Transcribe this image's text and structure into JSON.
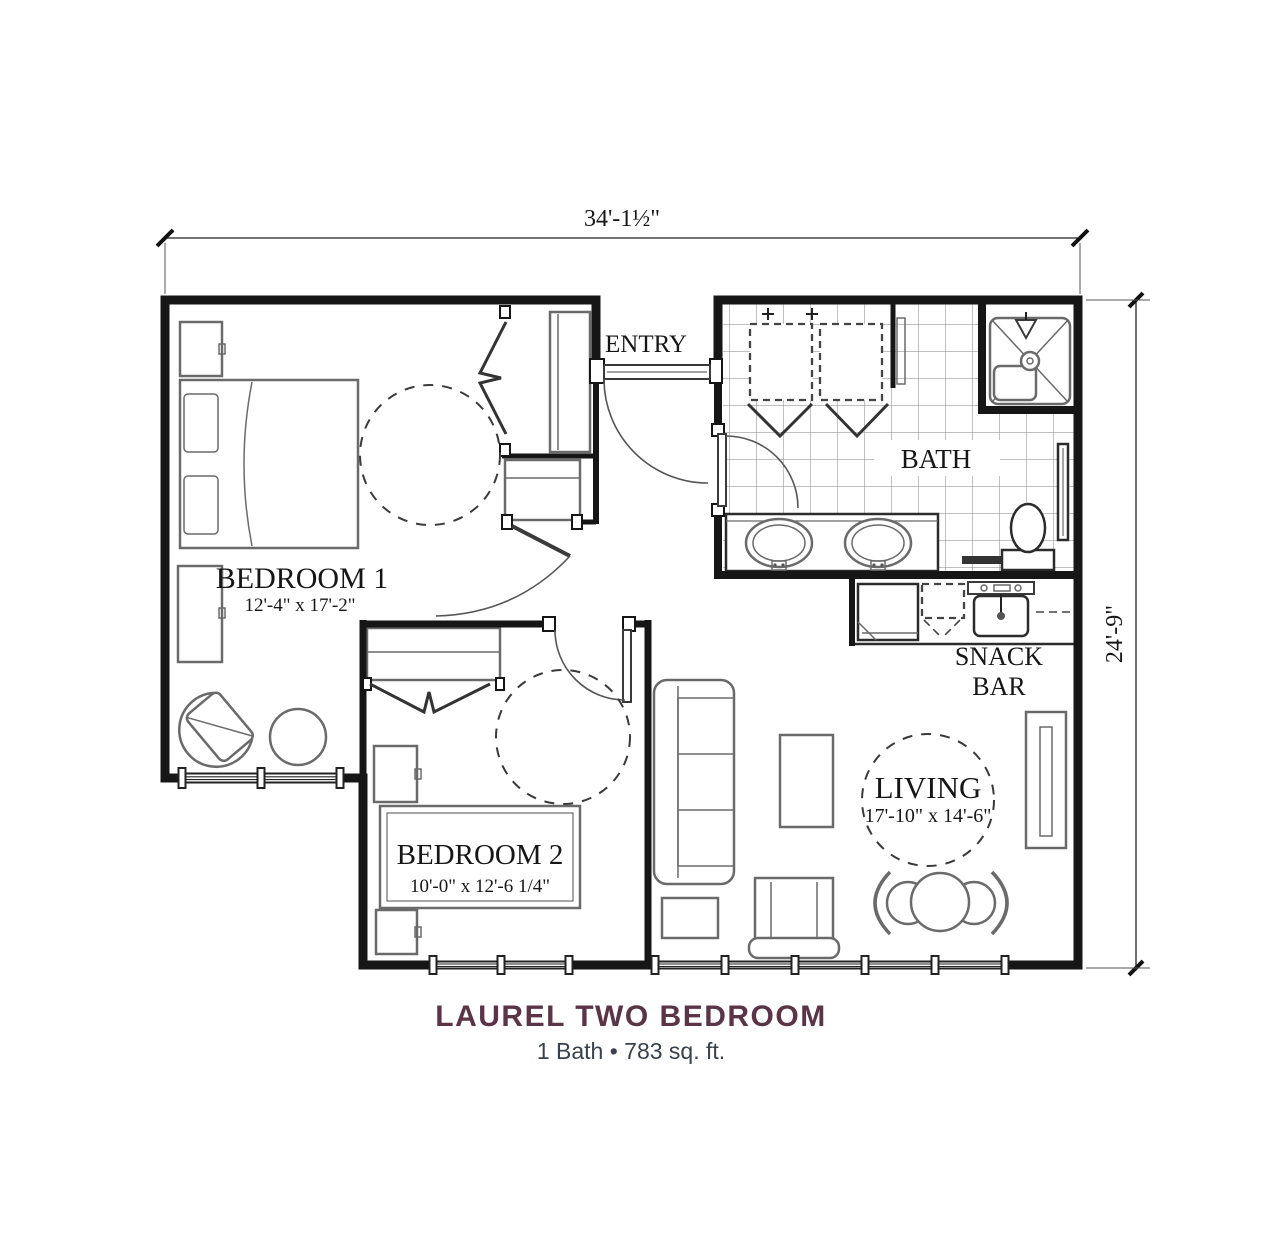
{
  "dimensions": {
    "width_label": "34'-1½\"",
    "height_label": "24'-9\""
  },
  "rooms": {
    "entry": {
      "label": "ENTRY"
    },
    "bath": {
      "label": "BATH"
    },
    "bedroom1": {
      "label": "BEDROOM 1",
      "dims": "12'-4\" x 17'-2\""
    },
    "bedroom2": {
      "label": "BEDROOM 2",
      "dims": "10'-0\" x 12'-6 1/4\""
    },
    "living": {
      "label": "LIVING",
      "dims": "17'-10\" x 14'-6\""
    },
    "snack_bar": {
      "line1": "SNACK",
      "line2": "BAR"
    }
  },
  "footer": {
    "title": "LAUREL TWO BEDROOM",
    "subtitle": "1 Bath • 783 sq. ft."
  },
  "colors": {
    "title": "#5c3447",
    "subtitle": "#3a414c",
    "walls": "#161616",
    "furniture": "#6a6a6a",
    "tile": "#9a9a9a"
  }
}
